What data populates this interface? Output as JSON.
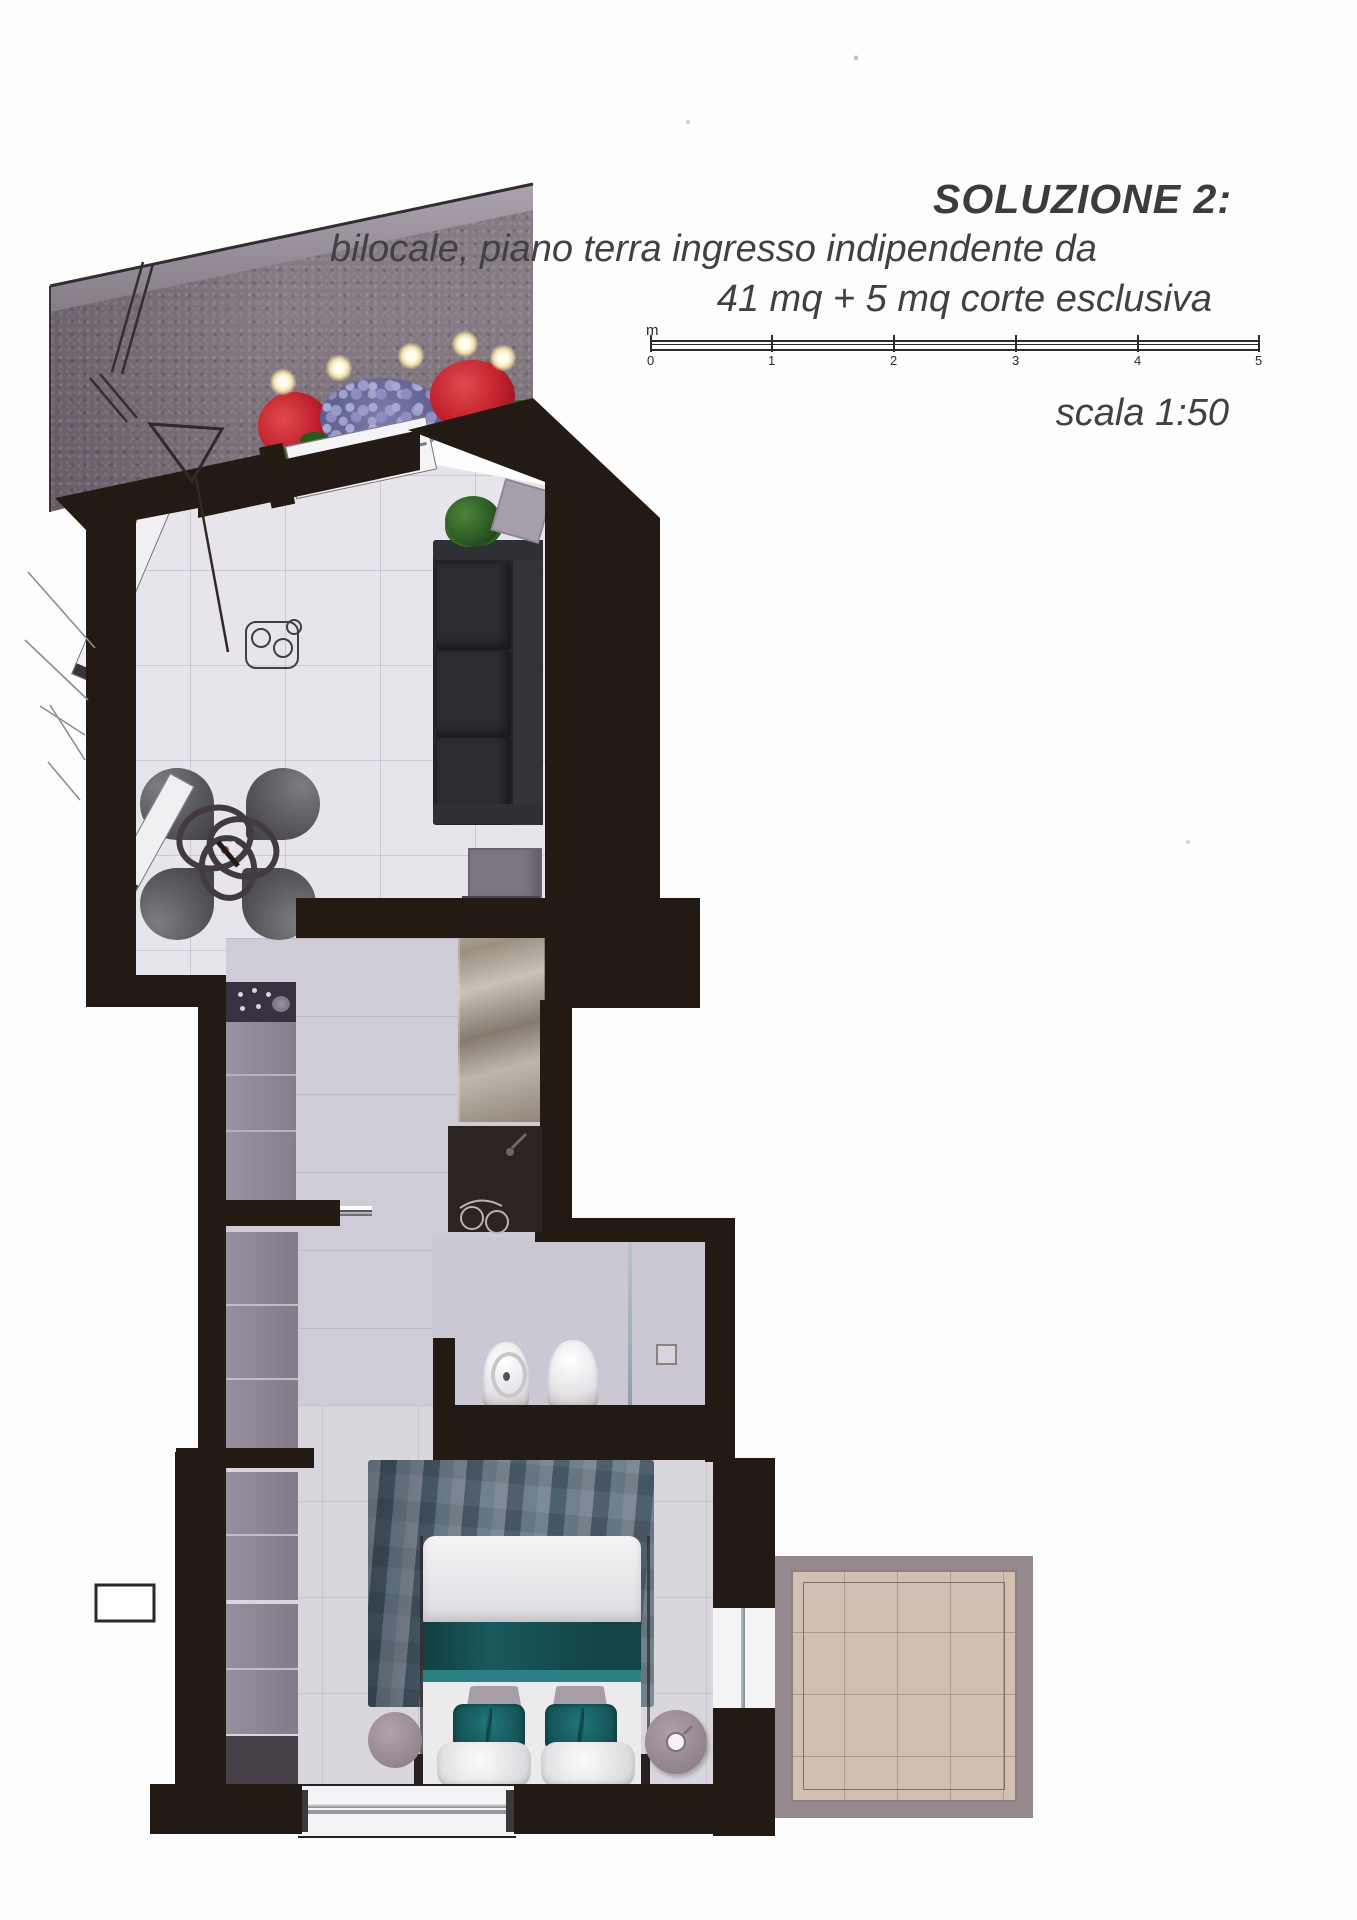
{
  "document": {
    "title": "SOLUZIONE 2:",
    "subtitle_line1": "bilocale, piano terra ingresso indipendente da",
    "subtitle_line2": "41 mq + 5 mq corte esclusiva",
    "scale_label": "scala 1:50"
  },
  "scale_bar": {
    "unit": "m",
    "ticks": [
      "0",
      "1",
      "2",
      "3",
      "4",
      "5"
    ]
  },
  "colors": {
    "wall": "#241a14",
    "courtyard_stone": "#867b85",
    "floor_living": "#e7e4eb",
    "floor_hall": "#cfcbd7",
    "floor_bedroom": "#dad6de",
    "patio_tile": "#d0bfb2",
    "accent_teal": "#1b6b6d",
    "rug_blue": "#5e6e7c",
    "flower_red": "#cb2431",
    "flower_lilac": "#8d8dc1",
    "chrome": "#c9c9ce",
    "text": "#3c3c3e"
  },
  "plan": {
    "elements": [
      "courtyard",
      "flower-bed",
      "entry-door",
      "dining-chairs",
      "ring-table",
      "sofa",
      "side-table",
      "plant",
      "kitchen-cooktop",
      "kitchen-counter",
      "sliding-door",
      "stone-feature-wall",
      "washbasin",
      "bidet",
      "toilet",
      "shower",
      "wardrobe",
      "bed",
      "rug",
      "pouf",
      "round-table",
      "patio",
      "window"
    ]
  }
}
